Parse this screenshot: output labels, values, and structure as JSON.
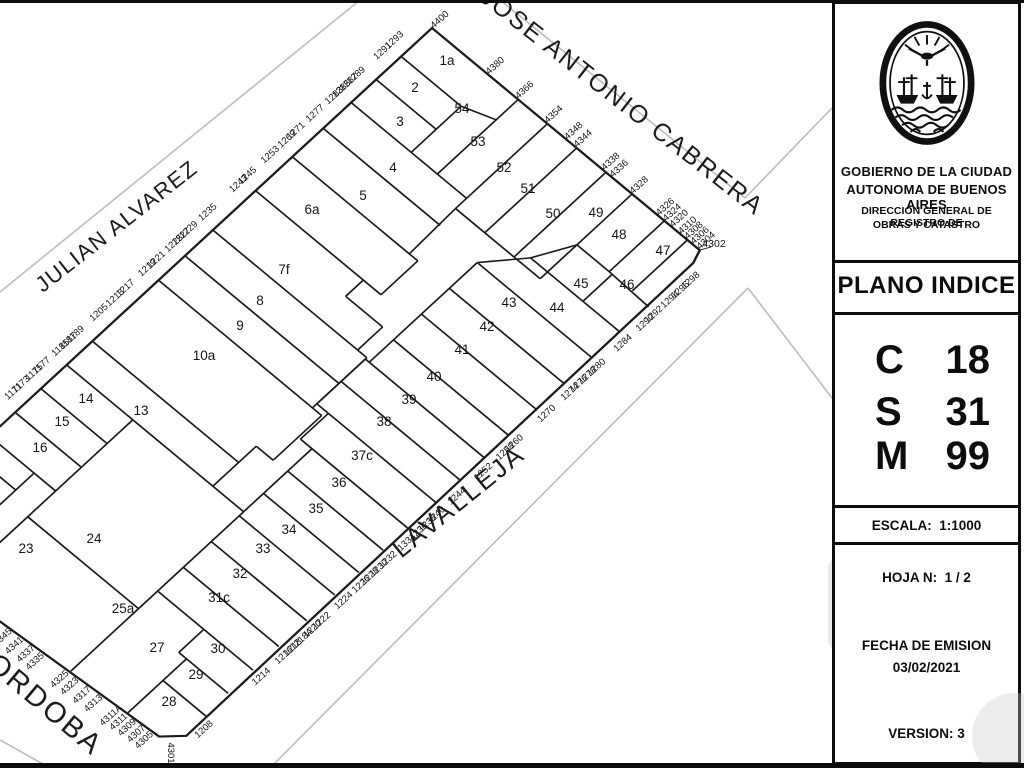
{
  "panel": {
    "gov_line1": "GOBIERNO DE LA CIUDAD",
    "gov_line2": "AUTONOMA DE BUENOS AIRES",
    "dept_line1": "DIRECCION GENERAL DE REGISTRO DE",
    "dept_line2": "OBRAS Y CATASTRO",
    "title": "PLANO INDICE",
    "cadastral": [
      {
        "key": "C",
        "value": "18"
      },
      {
        "key": "S",
        "value": "31"
      },
      {
        "key": "M",
        "value": "99"
      }
    ],
    "scale_label": "ESCALA:",
    "scale_value": "1:1000",
    "sheet_label": "HOJA N:",
    "sheet_value": "1 / 2",
    "emission_label": "FECHA DE EMISION",
    "emission_date": "03/02/2021",
    "version_label": "VERSION:",
    "version_value": "3"
  },
  "map": {
    "matrix": [
      0.7695,
      0.6384,
      -0.7351,
      0.6779,
      432,
      28
    ],
    "streets": [
      {
        "name": "JOSE ANTONIO CABRERA",
        "x": 617,
        "y": 108,
        "rotation": 38,
        "size": 25,
        "spacing": 2
      },
      {
        "name": "JULIAN ALVAREZ",
        "x": 121,
        "y": 232,
        "rotation": -38,
        "size": 22,
        "spacing": 1.5
      },
      {
        "name": "LAVALLEJA",
        "x": 464,
        "y": 508,
        "rotation": -39,
        "size": 26,
        "spacing": 2.5
      },
      {
        "name": "CORDOBA",
        "x": 30,
        "y": 704,
        "rotation": 40,
        "size": 29,
        "spacing": 2.5
      }
    ],
    "lots": [
      {
        "n": "1a",
        "x": 447,
        "y": 65
      },
      {
        "n": "2",
        "x": 415,
        "y": 92
      },
      {
        "n": "54",
        "x": 462,
        "y": 113
      },
      {
        "n": "3",
        "x": 400,
        "y": 126
      },
      {
        "n": "53",
        "x": 478,
        "y": 146
      },
      {
        "n": "4",
        "x": 393,
        "y": 172
      },
      {
        "n": "52",
        "x": 504,
        "y": 172
      },
      {
        "n": "51",
        "x": 528,
        "y": 193
      },
      {
        "n": "5",
        "x": 363,
        "y": 200
      },
      {
        "n": "50",
        "x": 553,
        "y": 218
      },
      {
        "n": "49",
        "x": 596,
        "y": 217
      },
      {
        "n": "6a",
        "x": 312,
        "y": 214
      },
      {
        "n": "48",
        "x": 619,
        "y": 239
      },
      {
        "n": "47",
        "x": 663,
        "y": 255
      },
      {
        "n": "7f",
        "x": 284,
        "y": 274
      },
      {
        "n": "45",
        "x": 581,
        "y": 288
      },
      {
        "n": "46",
        "x": 627,
        "y": 289
      },
      {
        "n": "8",
        "x": 260,
        "y": 305
      },
      {
        "n": "43",
        "x": 509,
        "y": 307
      },
      {
        "n": "44",
        "x": 557,
        "y": 312
      },
      {
        "n": "9",
        "x": 240,
        "y": 330
      },
      {
        "n": "42",
        "x": 487,
        "y": 331
      },
      {
        "n": "41",
        "x": 462,
        "y": 354
      },
      {
        "n": "10a",
        "x": 204,
        "y": 360
      },
      {
        "n": "40",
        "x": 434,
        "y": 381
      },
      {
        "n": "39",
        "x": 409,
        "y": 404
      },
      {
        "n": "13",
        "x": 141,
        "y": 415
      },
      {
        "n": "14",
        "x": 86,
        "y": 403
      },
      {
        "n": "38",
        "x": 384,
        "y": 426
      },
      {
        "n": "15",
        "x": 62,
        "y": 426
      },
      {
        "n": "37c",
        "x": 362,
        "y": 460
      },
      {
        "n": "16",
        "x": 40,
        "y": 452
      },
      {
        "n": "36",
        "x": 339,
        "y": 487
      },
      {
        "n": "35",
        "x": 316,
        "y": 513
      },
      {
        "n": "34",
        "x": 289,
        "y": 534
      },
      {
        "n": "24",
        "x": 94,
        "y": 543
      },
      {
        "n": "23",
        "x": 26,
        "y": 553
      },
      {
        "n": "33",
        "x": 263,
        "y": 553
      },
      {
        "n": "32",
        "x": 240,
        "y": 578
      },
      {
        "n": "31c",
        "x": 219,
        "y": 602
      },
      {
        "n": "25a",
        "x": 123,
        "y": 613
      },
      {
        "n": "30",
        "x": 218,
        "y": 653
      },
      {
        "n": "27",
        "x": 157,
        "y": 652
      },
      {
        "n": "29",
        "x": 196,
        "y": 679
      },
      {
        "n": "28",
        "x": 169,
        "y": 706
      }
    ],
    "addresses": [
      {
        "t": "1293",
        "lx": -14,
        "ly": 34
      },
      {
        "t": "1291",
        "lx": -14,
        "ly": 50
      },
      {
        "t": "1289",
        "lx": -14,
        "ly": 86
      },
      {
        "t": "1287",
        "lx": -14,
        "ly": 96
      },
      {
        "t": "1285",
        "lx": -14,
        "ly": 106
      },
      {
        "t": "1283",
        "lx": -14,
        "ly": 116
      },
      {
        "t": "1277",
        "lx": -14,
        "ly": 142
      },
      {
        "t": "1271",
        "lx": -14,
        "ly": 168
      },
      {
        "t": "1269",
        "lx": -14,
        "ly": 180
      },
      {
        "t": "1253",
        "lx": -14,
        "ly": 203
      },
      {
        "t": "1245",
        "lx": -14,
        "ly": 234
      },
      {
        "t": "1243",
        "lx": -14,
        "ly": 246
      },
      {
        "t": "1235",
        "lx": -14,
        "ly": 288
      },
      {
        "t": "1229",
        "lx": -14,
        "ly": 314
      },
      {
        "t": "1227",
        "lx": -14,
        "ly": 324
      },
      {
        "t": "1225",
        "lx": -14,
        "ly": 334
      },
      {
        "t": "1221",
        "lx": -14,
        "ly": 358
      },
      {
        "t": "1219",
        "lx": -14,
        "ly": 370
      },
      {
        "t": "1217",
        "lx": -14,
        "ly": 400
      },
      {
        "t": "1213",
        "lx": -14,
        "ly": 414
      },
      {
        "t": "1205",
        "lx": -14,
        "ly": 436
      },
      {
        "t": "1189",
        "lx": -14,
        "ly": 468
      },
      {
        "t": "1187",
        "lx": -14,
        "ly": 478
      },
      {
        "t": "1185",
        "lx": -14,
        "ly": 488
      },
      {
        "t": "1177",
        "lx": -14,
        "ly": 514
      },
      {
        "t": "1175",
        "lx": -14,
        "ly": 524
      },
      {
        "t": "1173",
        "lx": -14,
        "ly": 542
      },
      {
        "t": "1171",
        "lx": -14,
        "ly": 552
      },
      {
        "t": "4400",
        "lx": 2,
        "ly": -11
      },
      {
        "t": "4380",
        "lx": 74,
        "ly": -11
      },
      {
        "t": "4366",
        "lx": 112,
        "ly": -11
      },
      {
        "t": "4354",
        "lx": 150,
        "ly": -11
      },
      {
        "t": "4348",
        "lx": 176,
        "ly": -11
      },
      {
        "t": "4344",
        "lx": 188,
        "ly": -11
      },
      {
        "t": "4338",
        "lx": 224,
        "ly": -11
      },
      {
        "t": "4336",
        "lx": 235,
        "ly": -11
      },
      {
        "t": "4328",
        "lx": 261,
        "ly": -11
      },
      {
        "t": "4326",
        "lx": 295,
        "ly": -11
      },
      {
        "t": "4324",
        "lx": 304,
        "ly": -11
      },
      {
        "t": "4320",
        "lx": 313,
        "ly": -11
      },
      {
        "t": "4310",
        "lx": 324,
        "ly": -11
      },
      {
        "t": "4308",
        "lx": 332,
        "ly": -11
      },
      {
        "t": "4306",
        "lx": 340,
        "ly": -11
      },
      {
        "t": "4304",
        "lx": 348,
        "ly": -11
      },
      {
        "t": "1298",
        "lx": 367,
        "ly": 30
      },
      {
        "t": "1296",
        "lx": 367,
        "ly": 44
      },
      {
        "t": "1294",
        "lx": 367,
        "ly": 58
      },
      {
        "t": "1292",
        "lx": 367,
        "ly": 80
      },
      {
        "t": "1290",
        "lx": 367,
        "ly": 92
      },
      {
        "t": "1284",
        "lx": 367,
        "ly": 122
      },
      {
        "t": "1280",
        "lx": 367,
        "ly": 158
      },
      {
        "t": "1278",
        "lx": 367,
        "ly": 170
      },
      {
        "t": "1276",
        "lx": 367,
        "ly": 182
      },
      {
        "t": "1274",
        "lx": 367,
        "ly": 194
      },
      {
        "t": "1270",
        "lx": 367,
        "ly": 226
      },
      {
        "t": "1260",
        "lx": 367,
        "ly": 270
      },
      {
        "t": "1258",
        "lx": 367,
        "ly": 282
      },
      {
        "t": "1252",
        "lx": 367,
        "ly": 312
      },
      {
        "t": "1244",
        "lx": 367,
        "ly": 348
      },
      {
        "t": "1240",
        "lx": 367,
        "ly": 376
      },
      {
        "t": "1238",
        "lx": 367,
        "ly": 388
      },
      {
        "t": "1236",
        "lx": 367,
        "ly": 400
      },
      {
        "t": "1334",
        "lx": 367,
        "ly": 416
      },
      {
        "t": "1232",
        "lx": 367,
        "ly": 442
      },
      {
        "t": "1230",
        "lx": 367,
        "ly": 454
      },
      {
        "t": "1228",
        "lx": 367,
        "ly": 466
      },
      {
        "t": "1226",
        "lx": 367,
        "ly": 478
      },
      {
        "t": "1224",
        "lx": 367,
        "ly": 502
      },
      {
        "t": "1222",
        "lx": 367,
        "ly": 532
      },
      {
        "t": "1220",
        "lx": 367,
        "ly": 544
      },
      {
        "t": "1218A",
        "lx": 367,
        "ly": 559
      },
      {
        "t": "1218",
        "lx": 367,
        "ly": 571
      },
      {
        "t": "1216",
        "lx": 367,
        "ly": 583
      },
      {
        "t": "1214",
        "lx": 367,
        "ly": 614
      },
      {
        "t": "1208",
        "lx": 367,
        "ly": 692
      },
      {
        "t": "4345",
        "lx": 161,
        "ly": 750
      },
      {
        "t": "4341",
        "lx": 175,
        "ly": 749
      },
      {
        "t": "4337",
        "lx": 189,
        "ly": 748
      },
      {
        "t": "4335",
        "lx": 201,
        "ly": 748
      },
      {
        "t": "4325",
        "lx": 231,
        "ly": 746
      },
      {
        "t": "4323",
        "lx": 243,
        "ly": 745
      },
      {
        "t": "4317",
        "lx": 258,
        "ly": 744
      },
      {
        "t": "4313",
        "lx": 272,
        "ly": 743
      },
      {
        "t": "4311A",
        "lx": 293,
        "ly": 741
      },
      {
        "t": "4311",
        "lx": 303,
        "ly": 741
      },
      {
        "t": "4309",
        "lx": 313,
        "ly": 740
      },
      {
        "t": "4307",
        "lx": 324,
        "ly": 739
      },
      {
        "t": "4305",
        "lx": 334,
        "ly": 739
      },
      {
        "t": "4302",
        "sx": 714,
        "sy": 247,
        "rot": 0,
        "fs": 10.5
      },
      {
        "t": "4301",
        "sx": 168,
        "sy": 753,
        "rot": 90
      }
    ],
    "outline": [
      [
        0,
        0
      ],
      [
        348,
        0
      ],
      [
        353,
        14
      ],
      [
        357,
        708
      ],
      [
        339,
        726
      ],
      [
        0,
        749
      ]
    ],
    "segments": [
      [
        0,
        42,
        78,
        42
      ],
      [
        78,
        42,
        112,
        30
      ],
      [
        112,
        0,
        112,
        110
      ],
      [
        78,
        42,
        78,
        110
      ],
      [
        0,
        76,
        78,
        76
      ],
      [
        0,
        110,
        150,
        110
      ],
      [
        150,
        0,
        150,
        125
      ],
      [
        0,
        148,
        152,
        148
      ],
      [
        188,
        0,
        188,
        125
      ],
      [
        226,
        0,
        226,
        125
      ],
      [
        260,
        0,
        260,
        125
      ],
      [
        302,
        0,
        302,
        75
      ],
      [
        332,
        0,
        332,
        75
      ],
      [
        302,
        75,
        355,
        77
      ],
      [
        260,
        75,
        302,
        75
      ],
      [
        238,
        115,
        260,
        75
      ],
      [
        306,
        75,
        306,
        115
      ],
      [
        238,
        115,
        354,
        115
      ],
      [
        205,
        153,
        354,
        153
      ],
      [
        205,
        153,
        238,
        115
      ],
      [
        150,
        125,
        260,
        125
      ],
      [
        150,
        125,
        152,
        190
      ],
      [
        0,
        190,
        163,
        190
      ],
      [
        163,
        190,
        163,
        240
      ],
      [
        0,
        240,
        163,
        240
      ],
      [
        140,
        240,
        140,
        264
      ],
      [
        140,
        264,
        188,
        264
      ],
      [
        188,
        264,
        188,
        298
      ],
      [
        0,
        298,
        200,
        298
      ],
      [
        0,
        336,
        200,
        336
      ],
      [
        0,
        372,
        212,
        372
      ],
      [
        200,
        298,
        200,
        372
      ],
      [
        205,
        153,
        205,
        300
      ],
      [
        200,
        300,
        205,
        300
      ],
      [
        200,
        300,
        200,
        366
      ],
      [
        205,
        191,
        354,
        191
      ],
      [
        205,
        229,
        354,
        229
      ],
      [
        205,
        267,
        354,
        267
      ],
      [
        205,
        300,
        354,
        300
      ],
      [
        200,
        333,
        354,
        333
      ],
      [
        200,
        366,
        354,
        366
      ],
      [
        215,
        366,
        215,
        404
      ],
      [
        215,
        404,
        354,
        404
      ],
      [
        230,
        404,
        230,
        732
      ],
      [
        230,
        437,
        354,
        437
      ],
      [
        230,
        470,
        354,
        470
      ],
      [
        230,
        503,
        354,
        503
      ],
      [
        230,
        541,
        354,
        541
      ],
      [
        230,
        579,
        354,
        579
      ],
      [
        230,
        614,
        354,
        614
      ],
      [
        290,
        614,
        290,
        648
      ],
      [
        290,
        648,
        354,
        648
      ],
      [
        300,
        648,
        300,
        729
      ],
      [
        300,
        680,
        356,
        680
      ],
      [
        212,
        372,
        212,
        438
      ],
      [
        190,
        438,
        212,
        438
      ],
      [
        190,
        438,
        190,
        497
      ],
      [
        0,
        462,
        190,
        462
      ],
      [
        0,
        497,
        230,
        497
      ],
      [
        86,
        497,
        86,
        743
      ],
      [
        0,
        532,
        86,
        532
      ],
      [
        0,
        567,
        86,
        567
      ],
      [
        0,
        602,
        86,
        602
      ],
      [
        86,
        640,
        230,
        640
      ],
      [
        58,
        602,
        58,
        743
      ],
      [
        0,
        627,
        58,
        627
      ],
      [
        0,
        652,
        58,
        652
      ],
      [
        0,
        677,
        58,
        677
      ],
      [
        0,
        702,
        58,
        702
      ],
      [
        0,
        727,
        58,
        727
      ]
    ],
    "gray_lines": [
      [
        0,
        292,
        360,
        0
      ],
      [
        500,
        0,
        745,
        198
      ],
      [
        745,
        198,
        832,
        108
      ],
      [
        748,
        288,
        270,
        768
      ],
      [
        748,
        288,
        832,
        398
      ],
      [
        0,
        740,
        50,
        768
      ]
    ],
    "ticks": [
      [
        700,
        250,
        711,
        247
      ]
    ]
  }
}
